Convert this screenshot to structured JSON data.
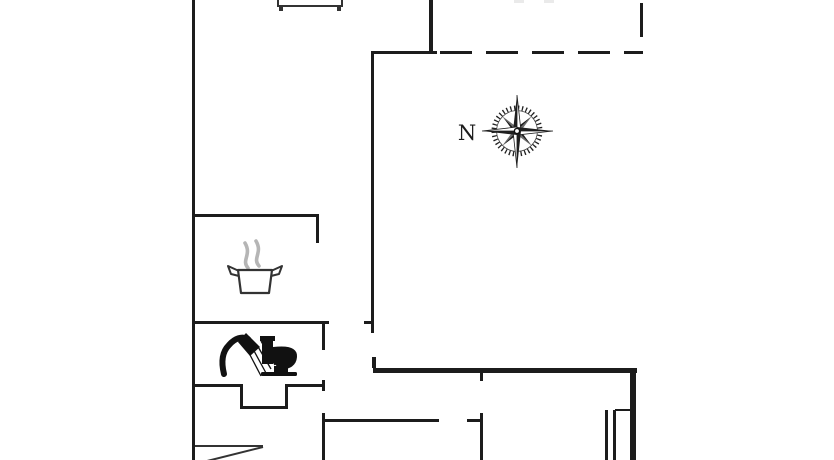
{
  "diagram": {
    "type": "floor-plan",
    "background": "#ffffff"
  },
  "compass": {
    "north_label": "N"
  },
  "icons": [
    "cooking-pot-steam-icon",
    "shower-icon",
    "toilet-icon",
    "compass-rose-icon"
  ],
  "colors": {
    "wall": "#1c1c1c",
    "thin_line": "#333333",
    "steam": "#b5b5b5",
    "background": "#ffffff"
  },
  "boundary_styles": {
    "solid": "wall",
    "dashed": "open-boundary"
  }
}
